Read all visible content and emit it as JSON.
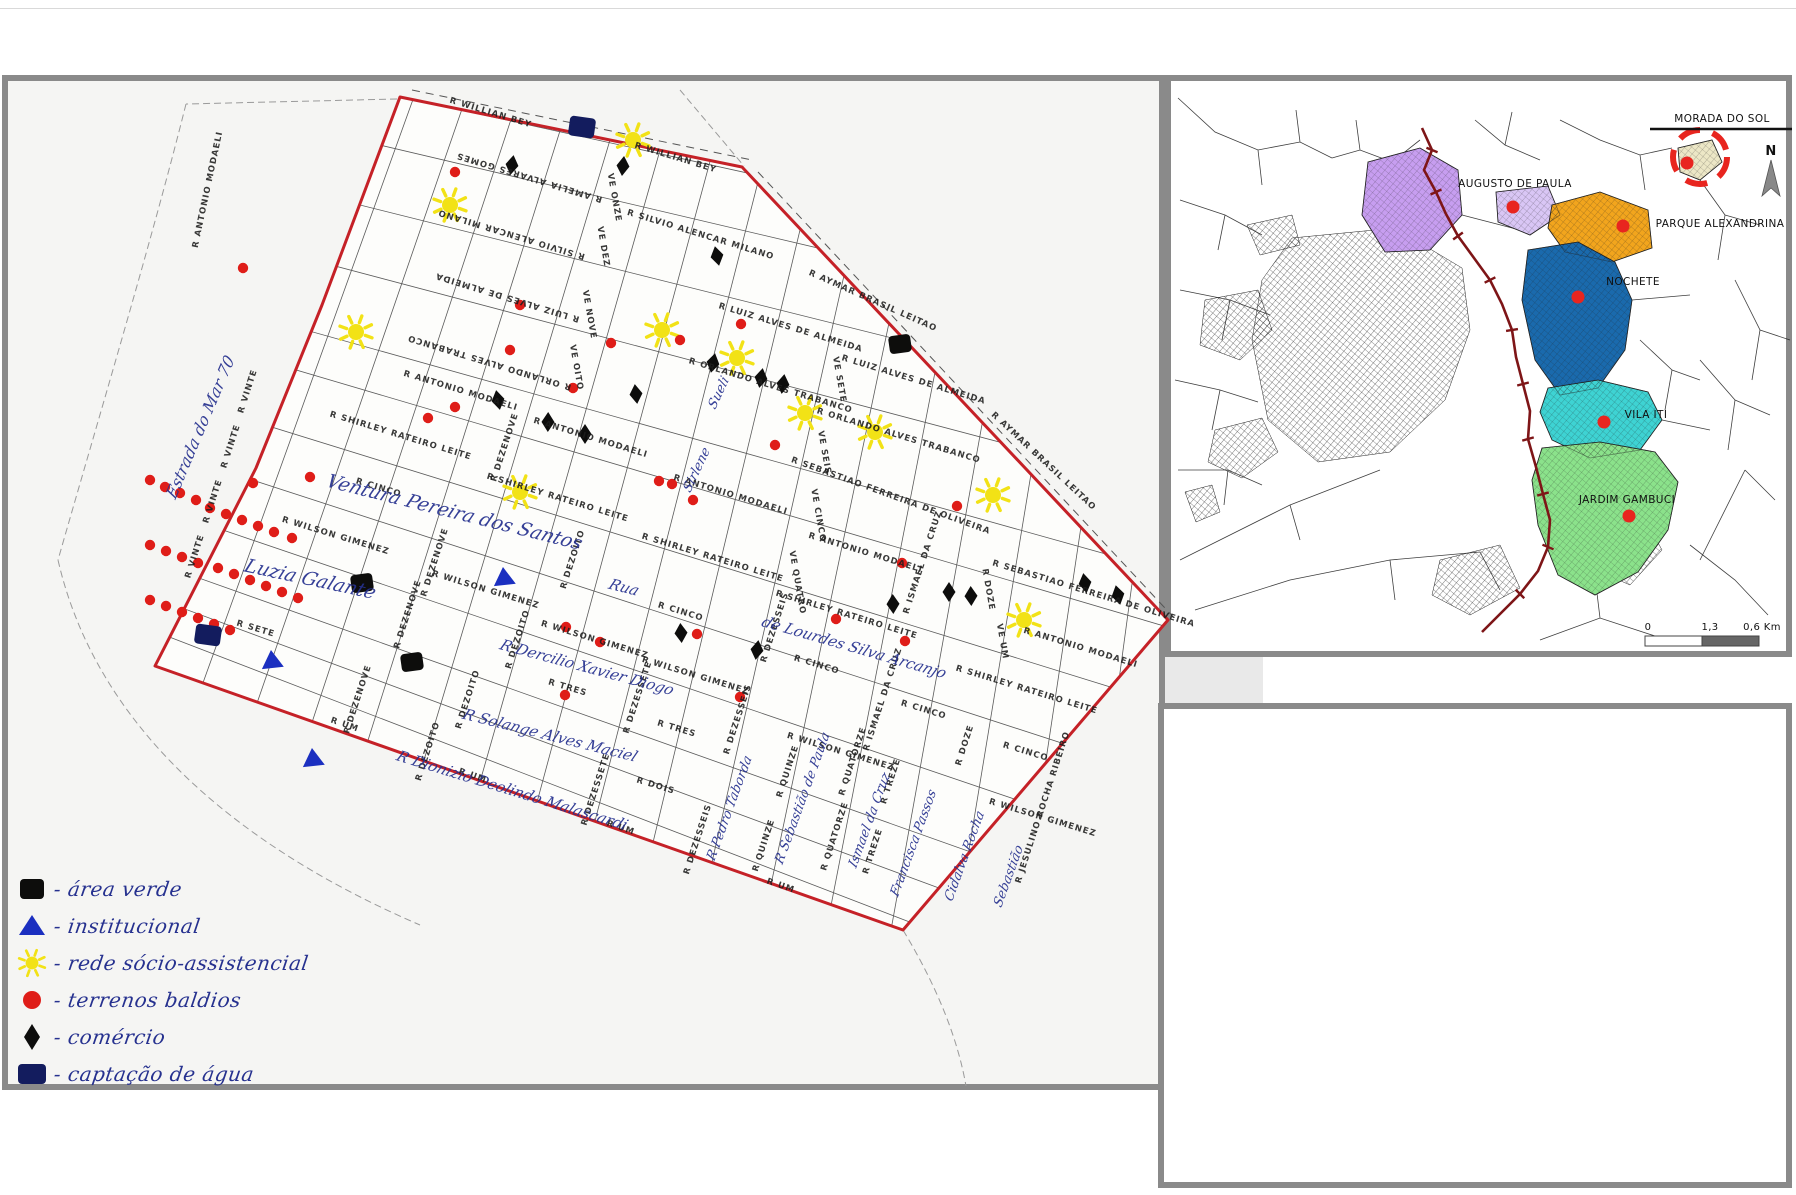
{
  "colors": {
    "boundary": "#c52127",
    "sun": "#f2e216",
    "red_dot": "#df1d18",
    "diamond": "#0d0d0c",
    "green_square": "#0d0d0c",
    "water_square": "#131c5e",
    "triangle": "#1b2fc0",
    "ink": "#26318f",
    "railway": "#7e1517",
    "inset_dot": "#e8251f",
    "grid": "#5a5a5a"
  },
  "legend": {
    "items": [
      {
        "symbol": "green-square",
        "label": "área verde"
      },
      {
        "symbol": "triangle",
        "label": "institucional"
      },
      {
        "symbol": "sun",
        "label": "rede sócio-assistencial"
      },
      {
        "symbol": "red-circle",
        "label": "terrenos baldios"
      },
      {
        "symbol": "diamond",
        "label": "comércio"
      },
      {
        "symbol": "water-square",
        "label": "captação de água"
      }
    ]
  },
  "main_map": {
    "street_labels": [
      {
        "t": "R WILLIAN BEY",
        "x": 490,
        "y": 115,
        "r": 17
      },
      {
        "t": "R WILLIAN BEY",
        "x": 675,
        "y": 160,
        "r": 17
      },
      {
        "t": "R AMELIA ALVARES GOMES",
        "x": 530,
        "y": 175,
        "r": 197
      },
      {
        "t": "R SILVIO ALENCAR MILANO",
        "x": 512,
        "y": 232,
        "r": 197
      },
      {
        "t": "R SILVIO ALENCAR MILANO",
        "x": 700,
        "y": 237,
        "r": 17
      },
      {
        "t": "R LUIZ ALVES DE ALMEIDA",
        "x": 508,
        "y": 295,
        "r": 197
      },
      {
        "t": "R LUIZ ALVES DE ALMEIDA",
        "x": 790,
        "y": 330,
        "r": 17
      },
      {
        "t": "R LUIZ ALVES DE ALMEIDA",
        "x": 913,
        "y": 382,
        "r": 17
      },
      {
        "t": "R AYMAR BRASIL LEITAO",
        "x": 872,
        "y": 303,
        "r": 24
      },
      {
        "t": "R AYMAR BRASIL LEITAO",
        "x": 1042,
        "y": 463,
        "r": 43
      },
      {
        "t": "R ORLANDO ALVES TRABANCO",
        "x": 490,
        "y": 360,
        "r": 197
      },
      {
        "t": "R ORLANDO ALVES TRABANCO",
        "x": 770,
        "y": 388,
        "r": 17
      },
      {
        "t": "R ORLANDO ALVES TRABANCO",
        "x": 898,
        "y": 438,
        "r": 17
      },
      {
        "t": "R ANTONIO MODAELI",
        "x": 460,
        "y": 393,
        "r": 17
      },
      {
        "t": "R ANTONIO MODAELI",
        "x": 590,
        "y": 440,
        "r": 17
      },
      {
        "t": "R ANTONIO MODAELI",
        "x": 730,
        "y": 497,
        "r": 17
      },
      {
        "t": "R ANTONIO MODAELI",
        "x": 865,
        "y": 555,
        "r": 17
      },
      {
        "t": "R ANTONIO MODAELI",
        "x": 1080,
        "y": 650,
        "r": 17
      },
      {
        "t": "R ANTONIO MODAELI",
        "x": 210,
        "y": 190,
        "r": -78
      },
      {
        "t": "R SEBASTIAO FERREIRA DE OLIVEIRA",
        "x": 890,
        "y": 498,
        "r": 20
      },
      {
        "t": "R SEBASTIAO FERREIRA DE OLIVEIRA",
        "x": 1093,
        "y": 596,
        "r": 17
      },
      {
        "t": "R SHIRLEY RATEIRO LEITE",
        "x": 400,
        "y": 438,
        "r": 17
      },
      {
        "t": "R SHIRLEY RATEIRO LEITE",
        "x": 557,
        "y": 500,
        "r": 17
      },
      {
        "t": "R SHIRLEY RATEIRO LEITE",
        "x": 712,
        "y": 560,
        "r": 17
      },
      {
        "t": "R SHIRLEY RATEIRO LEITE",
        "x": 846,
        "y": 617,
        "r": 17
      },
      {
        "t": "R SHIRLEY RATEIRO LEITE",
        "x": 1026,
        "y": 692,
        "r": 17
      },
      {
        "t": "R CINCO",
        "x": 378,
        "y": 490,
        "r": 17
      },
      {
        "t": "R CINCO",
        "x": 680,
        "y": 614,
        "r": 17
      },
      {
        "t": "R CINCO",
        "x": 816,
        "y": 667,
        "r": 17
      },
      {
        "t": "R CINCO",
        "x": 923,
        "y": 712,
        "r": 17
      },
      {
        "t": "R CINCO",
        "x": 1025,
        "y": 754,
        "r": 17
      },
      {
        "t": "R WILSON GIMENEZ",
        "x": 335,
        "y": 538,
        "r": 17
      },
      {
        "t": "R WILSON GIMENEZ",
        "x": 485,
        "y": 592,
        "r": 17
      },
      {
        "t": "R WILSON GIMENEZ",
        "x": 594,
        "y": 642,
        "r": 17
      },
      {
        "t": "R WILSON GIMENEZ",
        "x": 695,
        "y": 678,
        "r": 17
      },
      {
        "t": "R WILSON GIMENEZ",
        "x": 840,
        "y": 754,
        "r": 17
      },
      {
        "t": "R WILSON GIMENEZ",
        "x": 1042,
        "y": 820,
        "r": 17
      },
      {
        "t": "R SETE",
        "x": 255,
        "y": 631,
        "r": 17
      },
      {
        "t": "R TRES",
        "x": 567,
        "y": 690,
        "r": 17
      },
      {
        "t": "R TRES",
        "x": 676,
        "y": 731,
        "r": 17
      },
      {
        "t": "R DOIS",
        "x": 655,
        "y": 788,
        "r": 17
      },
      {
        "t": "R UM",
        "x": 344,
        "y": 727,
        "r": 19
      },
      {
        "t": "R UM",
        "x": 472,
        "y": 778,
        "r": 19
      },
      {
        "t": "R UM",
        "x": 620,
        "y": 830,
        "r": 19
      },
      {
        "t": "R UM",
        "x": 780,
        "y": 888,
        "r": 19
      },
      {
        "t": "VE ONZE",
        "x": 612,
        "y": 198,
        "r": 80
      },
      {
        "t": "VE DEZ",
        "x": 601,
        "y": 247,
        "r": 80
      },
      {
        "t": "VE NOVE",
        "x": 587,
        "y": 315,
        "r": 80
      },
      {
        "t": "VE OITO",
        "x": 574,
        "y": 368,
        "r": 80
      },
      {
        "t": "VE SETE",
        "x": 837,
        "y": 380,
        "r": 80
      },
      {
        "t": "VE SEIS",
        "x": 822,
        "y": 453,
        "r": 80
      },
      {
        "t": "VE CINCO",
        "x": 816,
        "y": 516,
        "r": 80
      },
      {
        "t": "VE QUATRO",
        "x": 795,
        "y": 583,
        "r": 80
      },
      {
        "t": "R DOZE",
        "x": 986,
        "y": 590,
        "r": 80
      },
      {
        "t": "VE UM",
        "x": 1000,
        "y": 642,
        "r": 80
      },
      {
        "t": "R VINTE",
        "x": 250,
        "y": 392,
        "r": -72
      },
      {
        "t": "R VINTE",
        "x": 233,
        "y": 447,
        "r": -72
      },
      {
        "t": "R VINTE",
        "x": 215,
        "y": 502,
        "r": -72
      },
      {
        "t": "R VINTE",
        "x": 197,
        "y": 557,
        "r": -72
      },
      {
        "t": "R DEZENOVE",
        "x": 507,
        "y": 448,
        "r": -72
      },
      {
        "t": "R DEZENOVE",
        "x": 437,
        "y": 563,
        "r": -72
      },
      {
        "t": "R DEZENOVE",
        "x": 410,
        "y": 615,
        "r": -72
      },
      {
        "t": "R DEZENOVE",
        "x": 360,
        "y": 700,
        "r": -72
      },
      {
        "t": "R DEZOITO",
        "x": 575,
        "y": 560,
        "r": -72
      },
      {
        "t": "R DEZOITO",
        "x": 520,
        "y": 640,
        "r": -72
      },
      {
        "t": "R DEZOITO",
        "x": 470,
        "y": 700,
        "r": -72
      },
      {
        "t": "R DEZOITO",
        "x": 430,
        "y": 752,
        "r": -72
      },
      {
        "t": "R DEZESSETE",
        "x": 640,
        "y": 698,
        "r": -72
      },
      {
        "t": "R DEZESSETE",
        "x": 598,
        "y": 790,
        "r": -72
      },
      {
        "t": "R DEZESSEIS",
        "x": 777,
        "y": 628,
        "r": -72
      },
      {
        "t": "R DEZESSEIS",
        "x": 740,
        "y": 720,
        "r": -72
      },
      {
        "t": "R DEZESSEIS",
        "x": 700,
        "y": 840,
        "r": -72
      },
      {
        "t": "R QUINZE",
        "x": 790,
        "y": 772,
        "r": -72
      },
      {
        "t": "R QUINZE",
        "x": 766,
        "y": 846,
        "r": -72
      },
      {
        "t": "R QUATORZE",
        "x": 855,
        "y": 762,
        "r": -72
      },
      {
        "t": "R QUATORZE",
        "x": 837,
        "y": 837,
        "r": -72
      },
      {
        "t": "R TREZE",
        "x": 893,
        "y": 782,
        "r": -72
      },
      {
        "t": "R TREZE",
        "x": 875,
        "y": 852,
        "r": -72
      },
      {
        "t": "R DOZE",
        "x": 967,
        "y": 746,
        "r": -72
      },
      {
        "t": "R ISMAEL DA CRUZ",
        "x": 925,
        "y": 563,
        "r": -72
      },
      {
        "t": "R ISMAEL DA CRUZ",
        "x": 885,
        "y": 700,
        "r": -72
      },
      {
        "t": "R JESULINO ROCHA RIBEIRO",
        "x": 1045,
        "y": 808,
        "r": -72
      }
    ],
    "handwritten_labels": [
      {
        "t": "Estrada do Mar 70",
        "x": 205,
        "y": 430,
        "r": -67,
        "s": 16
      },
      {
        "t": "Ventura Pereira dos Santos",
        "x": 452,
        "y": 518,
        "r": 14,
        "s": 19
      },
      {
        "t": "Luzia Galante",
        "x": 308,
        "y": 585,
        "r": 12,
        "s": 19
      },
      {
        "t": "Rua",
        "x": 622,
        "y": 592,
        "r": 14,
        "s": 15
      },
      {
        "t": "de Lourdes Silva Arcanjo",
        "x": 852,
        "y": 652,
        "r": 16,
        "s": 15
      },
      {
        "t": "R Dercilio Xavier Diogo",
        "x": 585,
        "y": 672,
        "r": 15,
        "s": 15
      },
      {
        "t": "R Solange Alves Maciel",
        "x": 548,
        "y": 740,
        "r": 14,
        "s": 15
      },
      {
        "t": "R Dionizio Deolindo Malascardi",
        "x": 510,
        "y": 795,
        "r": 17,
        "s": 15
      },
      {
        "t": "Sueli",
        "x": 722,
        "y": 395,
        "r": -65,
        "s": 13
      },
      {
        "t": "Sirlene",
        "x": 700,
        "y": 472,
        "r": -65,
        "s": 13
      },
      {
        "t": "R Pedro Taborda",
        "x": 733,
        "y": 810,
        "r": -70,
        "s": 13
      },
      {
        "t": "R Sebastião de Paula",
        "x": 806,
        "y": 800,
        "r": -70,
        "s": 13
      },
      {
        "t": "Ismael da Cruz",
        "x": 873,
        "y": 822,
        "r": -70,
        "s": 13
      },
      {
        "t": "Francisca Passos",
        "x": 917,
        "y": 845,
        "r": -70,
        "s": 13
      },
      {
        "t": "Cidalva Rocha",
        "x": 968,
        "y": 858,
        "r": -70,
        "s": 13
      },
      {
        "t": "Sebastião",
        "x": 1012,
        "y": 878,
        "r": -70,
        "s": 13
      }
    ],
    "markers": {
      "suns": [
        [
          633,
          140
        ],
        [
          450,
          205
        ],
        [
          356,
          332
        ],
        [
          662,
          330
        ],
        [
          737,
          358
        ],
        [
          805,
          413
        ],
        [
          520,
          492
        ],
        [
          875,
          432
        ],
        [
          993,
          495
        ],
        [
          1024,
          620
        ]
      ],
      "red_dots": [
        [
          150,
          480
        ],
        [
          165,
          487
        ],
        [
          180,
          493
        ],
        [
          196,
          500
        ],
        [
          210,
          508
        ],
        [
          226,
          514
        ],
        [
          242,
          520
        ],
        [
          258,
          526
        ],
        [
          274,
          532
        ],
        [
          292,
          538
        ],
        [
          150,
          545
        ],
        [
          166,
          551
        ],
        [
          182,
          557
        ],
        [
          198,
          563
        ],
        [
          218,
          568
        ],
        [
          234,
          574
        ],
        [
          250,
          580
        ],
        [
          266,
          586
        ],
        [
          282,
          592
        ],
        [
          298,
          598
        ],
        [
          150,
          600
        ],
        [
          166,
          606
        ],
        [
          182,
          612
        ],
        [
          198,
          618
        ],
        [
          214,
          624
        ],
        [
          230,
          630
        ],
        [
          455,
          172
        ],
        [
          243,
          268
        ],
        [
          611,
          343
        ],
        [
          510,
          350
        ],
        [
          741,
          324
        ],
        [
          455,
          407
        ],
        [
          573,
          388
        ],
        [
          659,
          481
        ],
        [
          672,
          484
        ],
        [
          310,
          477
        ],
        [
          253,
          483
        ],
        [
          428,
          418
        ],
        [
          520,
          305
        ],
        [
          680,
          340
        ],
        [
          775,
          445
        ],
        [
          693,
          500
        ],
        [
          902,
          563
        ],
        [
          836,
          619
        ],
        [
          566,
          627
        ],
        [
          600,
          642
        ],
        [
          697,
          634
        ],
        [
          740,
          697
        ],
        [
          565,
          695
        ],
        [
          905,
          641
        ],
        [
          957,
          506
        ]
      ],
      "diamonds": [
        [
          512,
          165
        ],
        [
          623,
          166
        ],
        [
          717,
          256
        ],
        [
          498,
          400
        ],
        [
          548,
          422
        ],
        [
          585,
          434
        ],
        [
          636,
          394
        ],
        [
          713,
          363
        ],
        [
          761,
          378
        ],
        [
          783,
          384
        ],
        [
          681,
          633
        ],
        [
          893,
          604
        ],
        [
          949,
          592
        ],
        [
          971,
          596
        ],
        [
          1085,
          583
        ],
        [
          1118,
          595
        ],
        [
          757,
          650
        ]
      ],
      "green_squares": [
        [
          900,
          344
        ],
        [
          412,
          662
        ],
        [
          362,
          583
        ]
      ],
      "water_squares": [
        [
          582,
          127
        ],
        [
          208,
          635
        ]
      ],
      "triangles": [
        [
          504,
          577
        ],
        [
          272,
          660
        ],
        [
          313,
          758
        ]
      ]
    }
  },
  "inset_map": {
    "title": "MORADA DO SOL",
    "north_label": "N",
    "regions": [
      {
        "name": "morada-do-sol",
        "label": "MORADA DO SOL",
        "color": "#ece7c6",
        "lx": 1722,
        "ly": 122,
        "dot": [
          1687,
          163
        ]
      },
      {
        "name": "augusto-de-paula",
        "label": "AUGUSTO DE PAULA",
        "color": "#d9c6f5",
        "lx": 1515,
        "ly": 187,
        "dot": [
          1513,
          207
        ]
      },
      {
        "name": "parque-alexandrina",
        "label": "PARQUE ALEXANDRINA",
        "color": "#f2a51d",
        "lx": 1720,
        "ly": 227,
        "dot": [
          1623,
          226
        ]
      },
      {
        "name": "nochete",
        "label": "NOCHETE",
        "color": "#1a6aad",
        "lx": 1633,
        "ly": 285,
        "dot": [
          1578,
          297
        ]
      },
      {
        "name": "vila-iti",
        "label": "VILA ITI",
        "color": "#3ed3d3",
        "lx": 1646,
        "ly": 418,
        "dot": [
          1604,
          422
        ]
      },
      {
        "name": "jardim-gambuci",
        "label": "JARDIM GAMBUCI",
        "color": "#8be28b",
        "lx": 1627,
        "ly": 503,
        "dot": [
          1629,
          516
        ]
      },
      {
        "name": "purple-region",
        "label": "",
        "color": "#c79ef0",
        "lx": 0,
        "ly": 0,
        "dot": null
      }
    ],
    "scale": {
      "labels": [
        {
          "t": "0",
          "x": 1648
        },
        {
          "t": "1,3",
          "x": 1710
        },
        {
          "t": "0,6 Km",
          "x": 1762
        }
      ]
    }
  }
}
